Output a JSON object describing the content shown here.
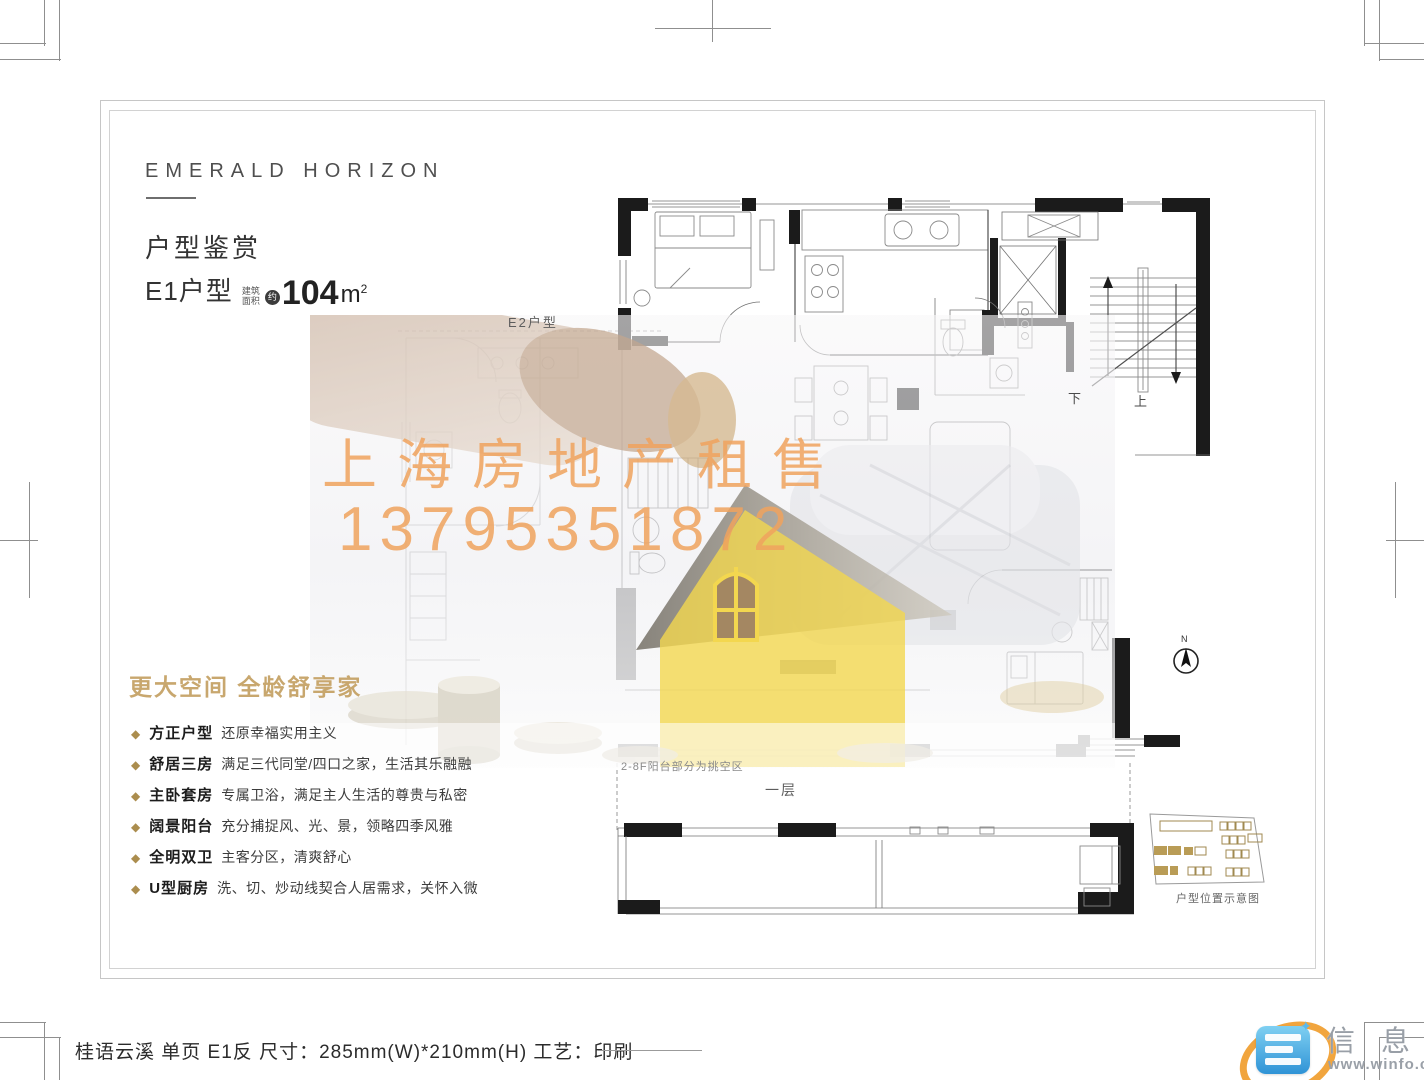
{
  "brand": {
    "name": "EMERALD HORIZON"
  },
  "section": {
    "title": "户型鉴赏"
  },
  "unit": {
    "name": "E1户型",
    "area_label_top": "建筑",
    "area_label_bottom": "面积",
    "approx": "约",
    "area_value": "104",
    "area_unit": "m",
    "area_sup": "2"
  },
  "features": {
    "heading": "更大空间  全龄舒享家",
    "items": [
      {
        "term": "方正户型",
        "desc": "还原幸福实用主义"
      },
      {
        "term": "舒居三房",
        "desc": "满足三代同堂/四口之家，生活其乐融融"
      },
      {
        "term": "主卧套房",
        "desc": "专属卫浴，满足主人生活的尊贵与私密"
      },
      {
        "term": "阔景阳台",
        "desc": "充分捕捉风、光、景，领略四季风雅"
      },
      {
        "term": "全明双卫",
        "desc": "主客分区，清爽舒心"
      },
      {
        "term": "U型厨房",
        "desc": "洗、切、炒动线契合人居需求，关怀入微"
      }
    ]
  },
  "watermark": {
    "line1": "上海房地产租售",
    "line2": "13795351872"
  },
  "plan": {
    "e2_label": "E2户型",
    "void_note": "2-8F阳台部分为挑空区",
    "first_floor_label": "一层",
    "stairs_down": "下",
    "stairs_up": "上",
    "north_label": "N",
    "sitemap_caption": "户型位置示意图"
  },
  "footer": {
    "caption": "桂语云溪 单页 E1反 尺寸：285mm(W)*210mm(H)  工艺：印刷"
  },
  "logo": {
    "name": "信 息 港",
    "url": "www.winfo.cc"
  },
  "colors": {
    "feature_gold": "#c8a76e",
    "bullet_gold": "#ab8d4e",
    "watermark_orange": "#f0a35e",
    "house_yellow": "#f3d74f",
    "logo_blue": "#3f9ad8",
    "logo_orange": "#f09d2e",
    "sitemap_gold": "#b99c56"
  }
}
